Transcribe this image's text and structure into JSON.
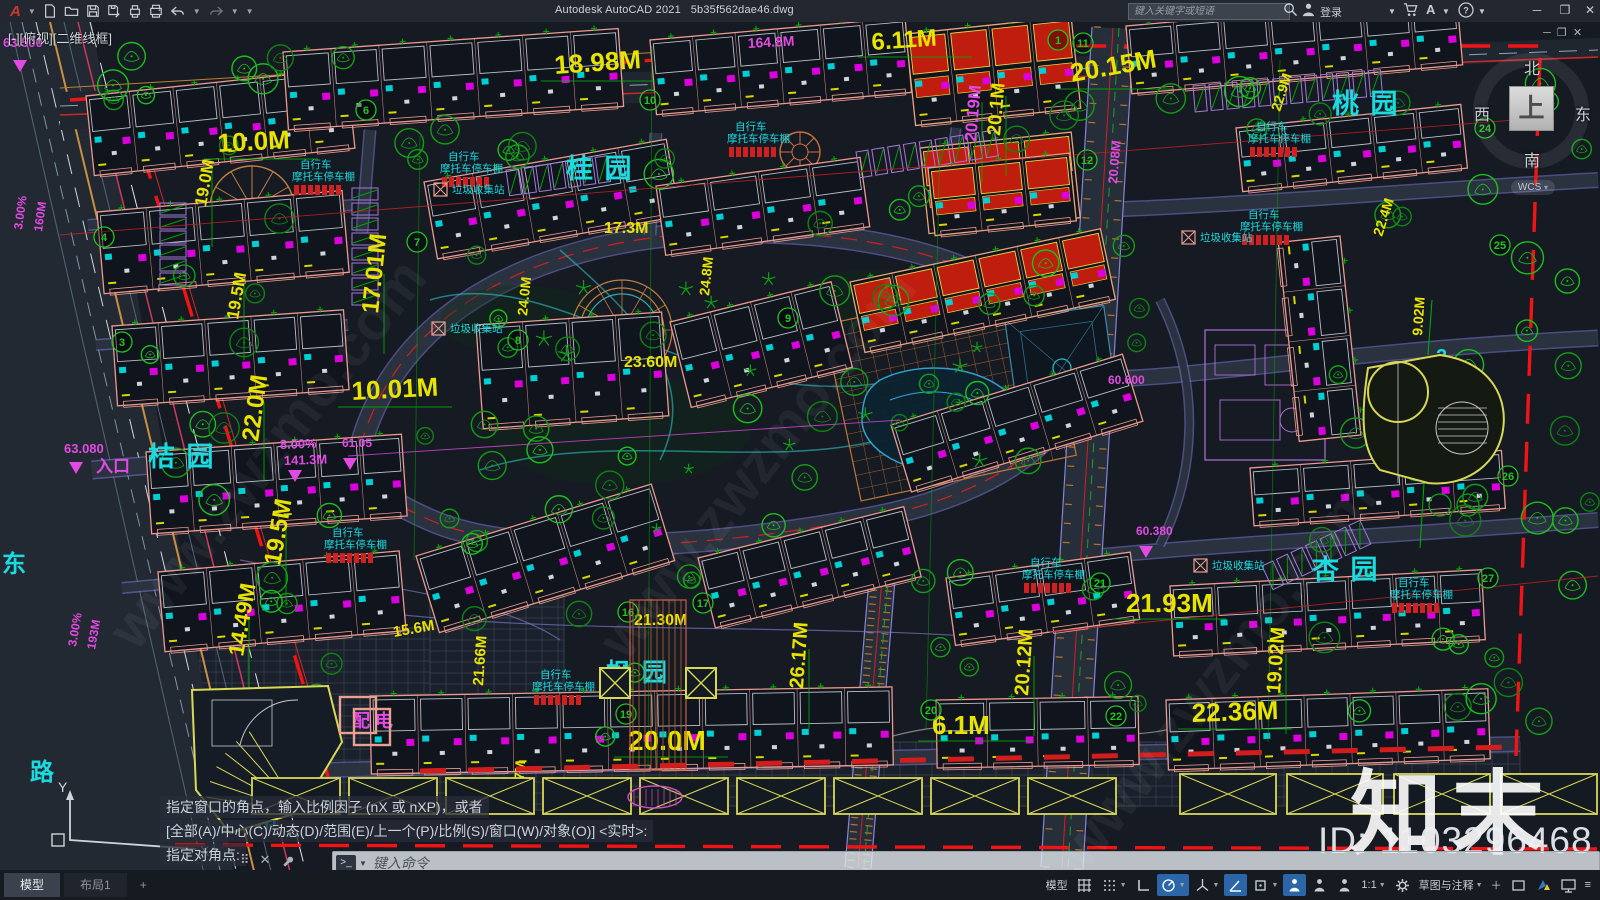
{
  "title_bar": {
    "app_title": "Autodesk AutoCAD 2021",
    "doc_name": "5b35f562dae46.dwg",
    "search_placeholder": "键入关键字或短语",
    "signin_label": "登录",
    "quick_icons": [
      "app-menu",
      "new-file",
      "open-folder",
      "save",
      "save-as",
      "plot",
      "print",
      "undo",
      "redo"
    ],
    "window_controls": {
      "min": "─",
      "max": "❐",
      "close": "✕"
    }
  },
  "viewport": {
    "controls_label": "[-][俯视][二维线框]",
    "viewcube": {
      "north": "北",
      "south": "南",
      "east": "东",
      "west": "西",
      "top": "上",
      "wcs_label": "WCS"
    },
    "ucs": {
      "x_label": "X",
      "y_label": "Y"
    }
  },
  "command_line": {
    "history": [
      "指定窗口的角点，输入比例因子 (nX 或 nXP)，或者",
      "[全部(A)/中心(C)/动态(D)/范围(E)/上一个(P)/比例(S)/窗口(W)/对象(O)] <实时>:",
      "指定对角点:"
    ],
    "prompt_glyph": ">_",
    "placeholder": "键入命令"
  },
  "tabs": {
    "model": "模型",
    "layout1": "布局1",
    "add": "+"
  },
  "status_bar": {
    "model_label": "模型",
    "scale_label": "1:1",
    "workspace_label": "草图与注释",
    "menu_glyph": "≡",
    "plus_glyph": "＋"
  },
  "watermarks": {
    "brand": "知末",
    "id_text": "ID: 1103296468",
    "diagonal": "www.zwzmo.com"
  },
  "colors": {
    "dim_yellow": "#e8e400",
    "grade_magenta": "#e34ae3",
    "label_cyan": "#19dbe0",
    "bubble_green": "#22c522",
    "tree_green": "#12a012",
    "boundary_red": "#f21414",
    "building_outline": "#eb9a8e",
    "road_edge_purple": "#7a7ad2"
  },
  "plan": {
    "gardens": [
      {
        "t": "桂  园",
        "x": 566,
        "y": 178,
        "s": 27
      },
      {
        "t": "桃  园",
        "x": 1332,
        "y": 113,
        "s": 27
      },
      {
        "t": "桔  园",
        "x": 148,
        "y": 466,
        "s": 27
      },
      {
        "t": "杏  园",
        "x": 1312,
        "y": 579,
        "s": 27
      },
      {
        "t": "枫  园",
        "x": 606,
        "y": 681,
        "s": 25
      },
      {
        "t": "超  市",
        "x": 222,
        "y": 827,
        "s": 23
      },
      {
        "t": "幼儿园",
        "x": 1382,
        "y": 430,
        "s": 14
      },
      {
        "t": "2",
        "x": 1436,
        "y": 363,
        "s": 20
      }
    ],
    "road_names": [
      {
        "t": "东",
        "x": 2,
        "y": 572,
        "s": 24
      },
      {
        "t": "路",
        "x": 30,
        "y": 780,
        "s": 24
      }
    ],
    "dims": [
      {
        "t": "18.98M",
        "x": 555,
        "y": 74,
        "s": 26,
        "r": -4
      },
      {
        "t": "6.11M",
        "x": 872,
        "y": 50,
        "s": 24,
        "r": -4
      },
      {
        "t": "20.15M",
        "x": 1072,
        "y": 82,
        "s": 26,
        "r": -10
      },
      {
        "t": "10.0M",
        "x": 218,
        "y": 152,
        "s": 26,
        "r": -3
      },
      {
        "t": "17.3M",
        "x": 604,
        "y": 233,
        "s": 16
      },
      {
        "t": "20.1M",
        "x": 1000,
        "y": 136,
        "s": 19,
        "r": -85
      },
      {
        "t": "20.19M",
        "x": 976,
        "y": 142,
        "s": 17,
        "r": -85,
        "c": "#e34ae3"
      },
      {
        "t": "22.9M",
        "x": 1280,
        "y": 112,
        "s": 14,
        "r": -72
      },
      {
        "t": "22.4M",
        "x": 1382,
        "y": 237,
        "s": 14,
        "r": -72
      },
      {
        "t": "19.0M",
        "x": 206,
        "y": 207,
        "s": 17,
        "r": -80
      },
      {
        "t": "19.5M",
        "x": 238,
        "y": 320,
        "s": 17,
        "r": -80
      },
      {
        "t": "17.01M",
        "x": 378,
        "y": 314,
        "s": 24,
        "r": -84
      },
      {
        "t": "22.0M",
        "x": 258,
        "y": 442,
        "s": 24,
        "r": -82
      },
      {
        "t": "19.5M",
        "x": 280,
        "y": 566,
        "s": 24,
        "r": -80
      },
      {
        "t": "14.49M",
        "x": 243,
        "y": 657,
        "s": 22,
        "r": -80
      },
      {
        "t": "15.6M",
        "x": 394,
        "y": 637,
        "s": 15,
        "r": -10
      },
      {
        "t": "21.66M",
        "x": 483,
        "y": 686,
        "s": 15,
        "r": -86
      },
      {
        "t": "21.30M",
        "x": 634,
        "y": 625,
        "s": 16
      },
      {
        "t": "20.0M",
        "x": 628,
        "y": 750,
        "s": 28
      },
      {
        "t": "26.17M",
        "x": 803,
        "y": 689,
        "s": 20,
        "r": -86
      },
      {
        "t": "6.1M",
        "x": 932,
        "y": 734,
        "s": 26
      },
      {
        "t": "20.12M",
        "x": 1028,
        "y": 696,
        "s": 20,
        "r": -86
      },
      {
        "t": "9.7M",
        "x": 523,
        "y": 792,
        "s": 14,
        "r": -86
      },
      {
        "t": "21.93M",
        "x": 1126,
        "y": 612,
        "s": 26
      },
      {
        "t": "22.36M",
        "x": 1192,
        "y": 722,
        "s": 26,
        "r": -2
      },
      {
        "t": "19.02M",
        "x": 1280,
        "y": 694,
        "s": 20,
        "r": -86
      },
      {
        "t": "23.60M",
        "x": 624,
        "y": 367,
        "s": 16
      },
      {
        "t": "10.01M",
        "x": 352,
        "y": 400,
        "s": 26,
        "r": -3
      },
      {
        "t": "24.0M",
        "x": 527,
        "y": 316,
        "s": 14,
        "r": -84
      },
      {
        "t": "24.8M",
        "x": 709,
        "y": 296,
        "s": 14,
        "r": -84
      },
      {
        "t": "9.02M",
        "x": 1422,
        "y": 336,
        "s": 14,
        "r": -86
      },
      {
        "t": "14.2M",
        "x": 1418,
        "y": 466,
        "s": 16,
        "r": -86
      }
    ],
    "grades": [
      {
        "t": "63.500",
        "x": 3,
        "y": 47,
        "s": 13
      },
      {
        "t": "9.00%",
        "x": 740,
        "y": 21,
        "s": 14,
        "r": -3
      },
      {
        "t": "164.8M",
        "x": 748,
        "y": 48,
        "s": 14,
        "r": -3
      },
      {
        "t": "3.00%",
        "x": 22,
        "y": 230,
        "s": 12,
        "r": -82
      },
      {
        "t": "160M",
        "x": 42,
        "y": 232,
        "s": 12,
        "r": -82
      },
      {
        "t": "63.080",
        "x": 64,
        "y": 453,
        "s": 13
      },
      {
        "t": "入口",
        "x": 96,
        "y": 472,
        "s": 17
      },
      {
        "t": "8.00%",
        "x": 280,
        "y": 449,
        "s": 13,
        "r": -2
      },
      {
        "t": "141.3M",
        "x": 284,
        "y": 465,
        "s": 13,
        "r": -2
      },
      {
        "t": "61.05",
        "x": 342,
        "y": 447,
        "s": 12
      },
      {
        "t": "3.00%",
        "x": 76,
        "y": 647,
        "s": 12,
        "r": -80
      },
      {
        "t": "193M",
        "x": 95,
        "y": 650,
        "s": 12,
        "r": -80
      },
      {
        "t": "60.600",
        "x": 1108,
        "y": 384,
        "s": 12
      },
      {
        "t": "60.380",
        "x": 1136,
        "y": 535,
        "s": 12
      },
      {
        "t": "20.08M",
        "x": 1117,
        "y": 184,
        "s": 13,
        "r": -85
      },
      {
        "t": "配 电",
        "x": 352,
        "y": 727,
        "s": 18
      }
    ],
    "shed_text": {
      "line1": "自行车",
      "line2": "摩托车停车棚"
    },
    "sheds": [
      {
        "x": 300,
        "y": 168
      },
      {
        "x": 448,
        "y": 160
      },
      {
        "x": 735,
        "y": 130
      },
      {
        "x": 1256,
        "y": 130
      },
      {
        "x": 1248,
        "y": 218
      },
      {
        "x": 332,
        "y": 536
      },
      {
        "x": 540,
        "y": 678
      },
      {
        "x": 1030,
        "y": 566
      },
      {
        "x": 1398,
        "y": 586
      }
    ],
    "trash_text": "垃圾收集站",
    "trash": [
      {
        "x": 452,
        "y": 193
      },
      {
        "x": 1200,
        "y": 241
      },
      {
        "x": 1212,
        "y": 569
      },
      {
        "x": 450,
        "y": 332
      }
    ],
    "bubbles": [
      {
        "n": "1",
        "x": 1058,
        "y": 40
      },
      {
        "n": "3",
        "x": 122,
        "y": 342
      },
      {
        "n": "4",
        "x": 104,
        "y": 237
      },
      {
        "n": "6",
        "x": 366,
        "y": 110
      },
      {
        "n": "7",
        "x": 417,
        "y": 242
      },
      {
        "n": "8",
        "x": 518,
        "y": 340
      },
      {
        "n": "9",
        "x": 788,
        "y": 318
      },
      {
        "n": "10",
        "x": 650,
        "y": 100
      },
      {
        "n": "11",
        "x": 1083,
        "y": 43
      },
      {
        "n": "12",
        "x": 1087,
        "y": 160
      },
      {
        "n": "16",
        "x": 628,
        "y": 612
      },
      {
        "n": "17",
        "x": 703,
        "y": 603
      },
      {
        "n": "19",
        "x": 626,
        "y": 714
      },
      {
        "n": "20",
        "x": 931,
        "y": 710
      },
      {
        "n": "21",
        "x": 1100,
        "y": 583
      },
      {
        "n": "22",
        "x": 1116,
        "y": 716
      },
      {
        "n": "24",
        "x": 1485,
        "y": 128
      },
      {
        "n": "25",
        "x": 1500,
        "y": 245
      },
      {
        "n": "26",
        "x": 1508,
        "y": 476
      },
      {
        "n": "27",
        "x": 1488,
        "y": 578
      }
    ]
  }
}
